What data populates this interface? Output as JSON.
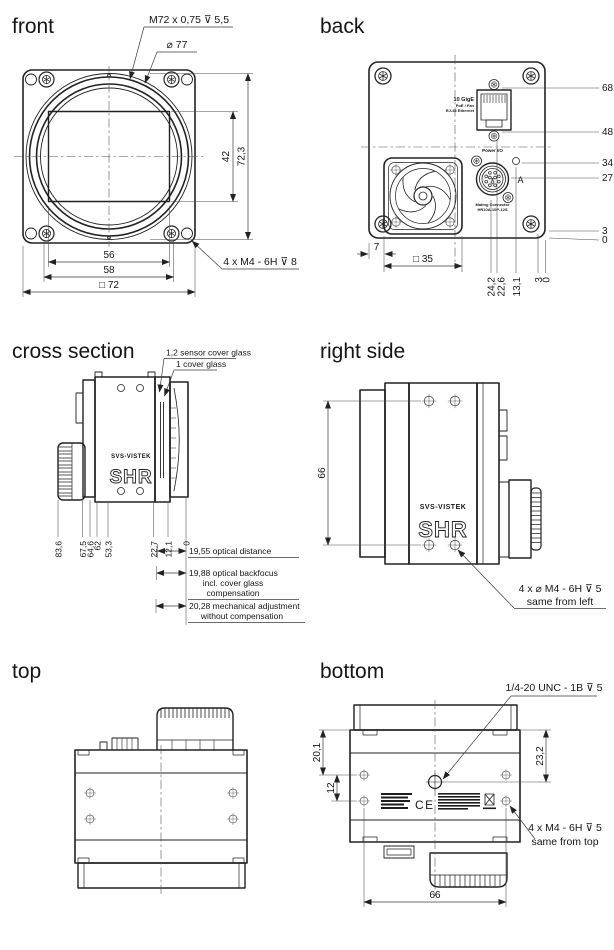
{
  "meta": {
    "ink": "#222222",
    "bg": "#ffffff"
  },
  "front": {
    "title": "front",
    "thread_note": "M72 x 0,75 ⊽ 5,5",
    "dia_note": "⌀ 77",
    "dim_sensor": "42",
    "dim_height": "72,3",
    "dim_56": "56",
    "dim_58": "58",
    "dim_width": "□ 72",
    "screw_note": "4 x M4 - 6H ⊽ 8"
  },
  "back": {
    "title": "back",
    "eth1": "10 GigE",
    "eth2": "PoE / Fan",
    "eth3": "RJ-45 Ethernet",
    "power_label": "Power I/O",
    "mating1": "Mating Connector",
    "mating2": "HR10A-10P-12S",
    "marker_a": "A",
    "d68": "68,5",
    "d48": "48,5",
    "d34": "34,3",
    "d27": "27,2",
    "d3r": "3",
    "d0r": "0",
    "d7": "7",
    "d35": "□ 35",
    "d242": "24,2",
    "d226": "22,6",
    "d131": "13,1",
    "d3b": "3",
    "d0b": "0"
  },
  "cross": {
    "title": "cross section",
    "glass1": "1,2 sensor cover glass",
    "glass2": "1 cover glass",
    "d836": "83,6",
    "d675": "67,5",
    "d646": "64,6",
    "d62": "62",
    "d533": "53,3",
    "d227": "22,7",
    "d121": "12,1",
    "d0": "0",
    "note1": "19,55 optical distance",
    "note2a": "19,88 optical backfocus",
    "note2b": "incl. cover glass",
    "note2c": "compensation",
    "note3a": "20,28 mechanical adjustment",
    "note3b": "without compensation",
    "brand": "SVS-VISTEK",
    "model": "SHR"
  },
  "right": {
    "title": "right side",
    "d66": "66",
    "note1": "4 x ⌀ M4 - 6H ⊽ 5",
    "note2": "same from left",
    "brand": "SVS-VISTEK",
    "model": "SHR"
  },
  "top": {
    "title": "top"
  },
  "bottom": {
    "title": "bottom",
    "tripod_note": "1/4-20 UNC - 1B ⊽ 5",
    "d201": "20,1",
    "d12": "12",
    "d232": "23,2",
    "d66": "66",
    "note1": "4 x M4 - 6H ⊽ 5",
    "note2": "same from top",
    "ce": "CE"
  }
}
